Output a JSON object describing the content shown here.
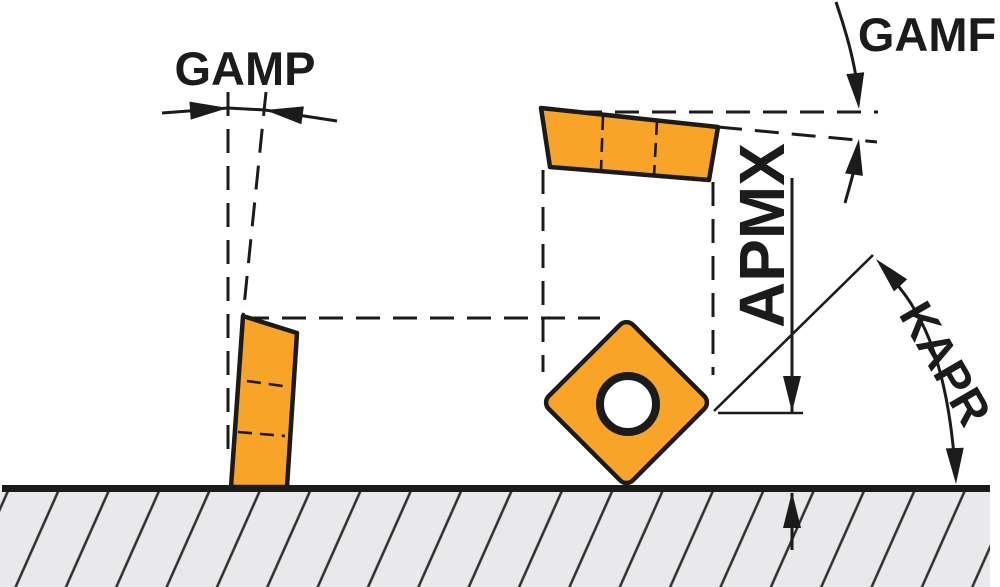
{
  "labels": {
    "gamp": "GAMP",
    "gamf": "GAMF",
    "apmx": "APMX",
    "kapr": "KAPR"
  },
  "colors": {
    "insert_fill": "#F7A428",
    "line": "#1b1b1b",
    "ground_fill": "#e9e9eb",
    "hatch_line": "#2e2e2e",
    "background": "#ffffff"
  }
}
